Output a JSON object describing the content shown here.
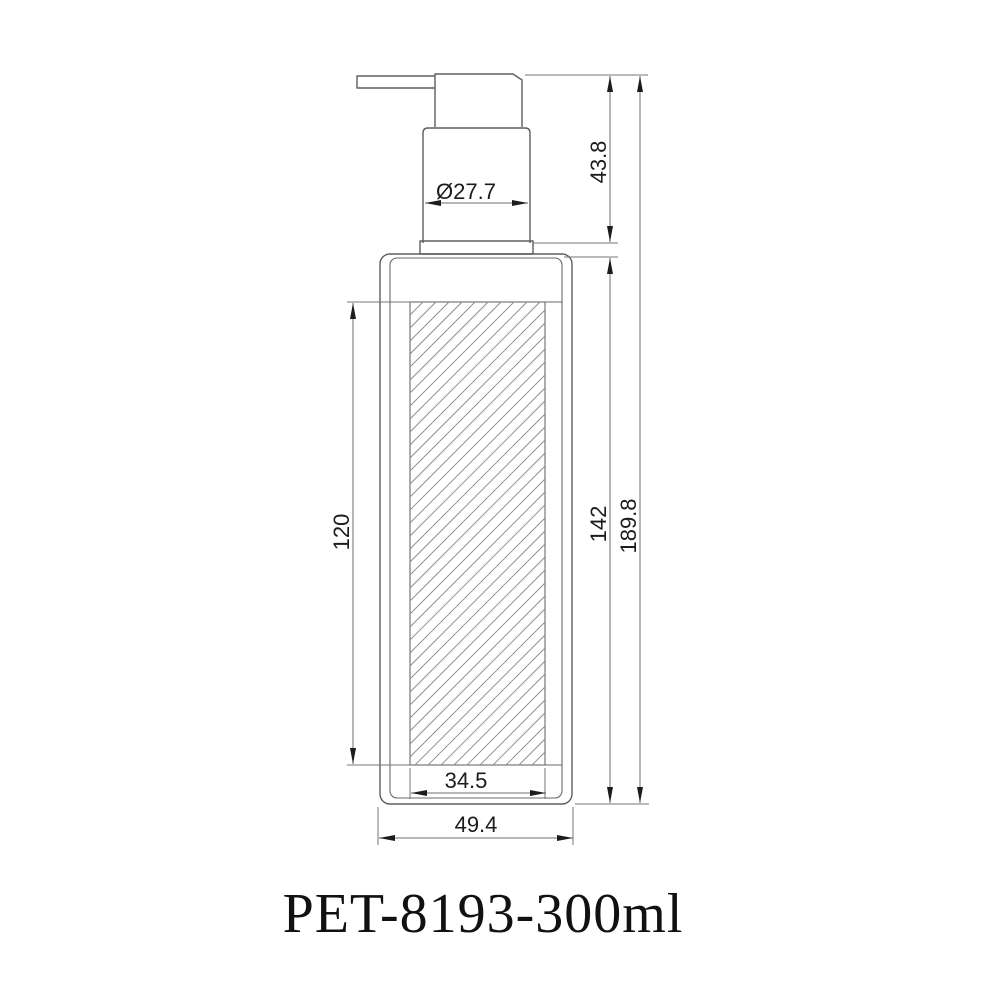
{
  "title": "PET-8193-300ml",
  "dimensions": {
    "pump_height": "43.8",
    "pump_diameter": "Ø27.7",
    "label_height": "120",
    "body_height": "142",
    "total_height": "189.8",
    "label_width": "34.5",
    "body_width": "49.4"
  },
  "colors": {
    "background": "#ffffff",
    "outline": "#5e5e5e",
    "dimension_lines": "#6f6f6f",
    "hatch": "#8a8a8a",
    "text": "#1c1c1c"
  }
}
